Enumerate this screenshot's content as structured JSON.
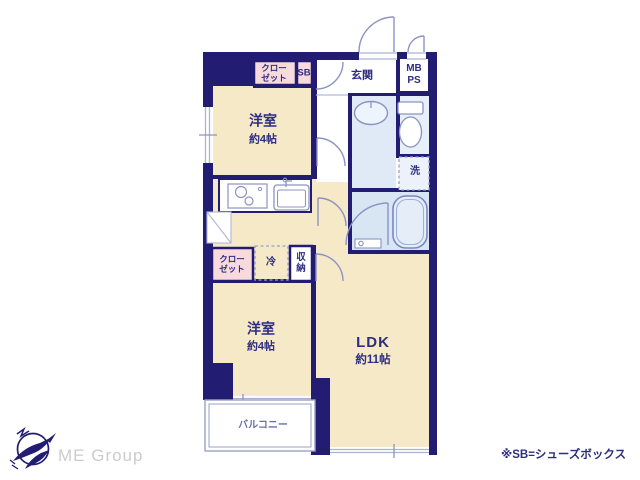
{
  "plan": {
    "rooms": {
      "bedroom_top": {
        "name": "洋室",
        "size": "約4帖"
      },
      "bedroom_bottom": {
        "name": "洋室",
        "size": "約4帖"
      },
      "ldk": {
        "name": "LDK",
        "size": "約11帖"
      },
      "entrance": {
        "label": "玄関"
      },
      "closet_top": {
        "line1": "クロー",
        "line2": "ゼット"
      },
      "closet_bottom": {
        "line1": "クロー",
        "line2": "ゼット"
      },
      "shoe_box": {
        "label": "SB"
      },
      "meter_box": {
        "line1": "MB",
        "line2": "PS"
      },
      "washer": {
        "label": "洗"
      },
      "fridge": {
        "label": "冷"
      },
      "storage": {
        "line1": "収",
        "line2": "納"
      },
      "balcony": {
        "label": "バルコニー"
      }
    },
    "colors": {
      "wall_navy": "#221d73",
      "floor_cream": "#f6e9c8",
      "closet_pink": "#f8dadc",
      "wet_area_blue": "#dfeaf6",
      "fixture_stroke": "#8b93c4",
      "label_navy": "#2d2d82"
    }
  },
  "footer": {
    "brand": "ME Group",
    "note": "※SB=シューズボックス"
  }
}
